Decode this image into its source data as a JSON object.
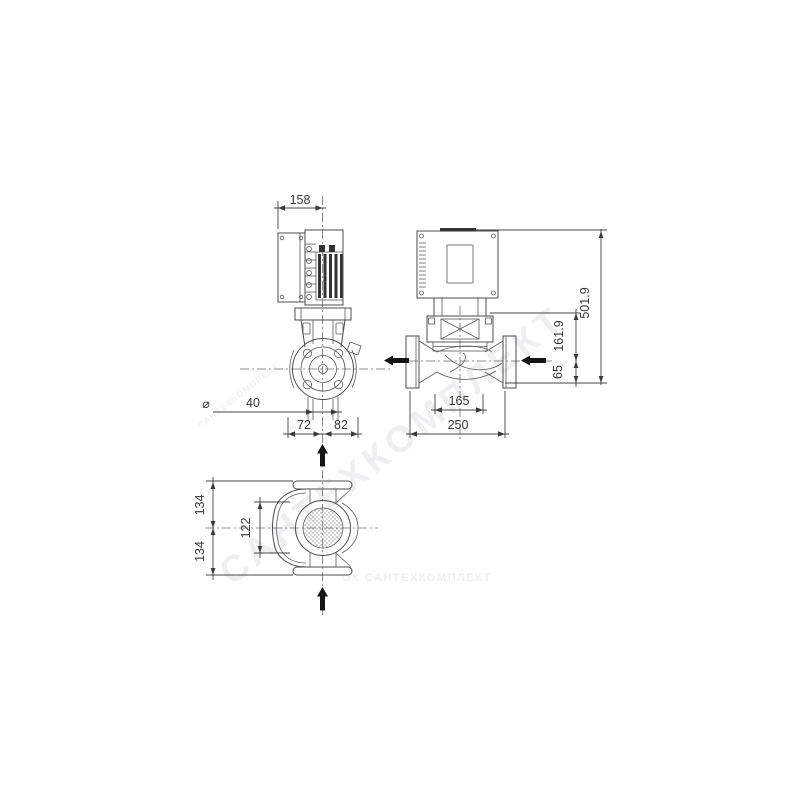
{
  "dims": {
    "front": {
      "motor_width": "158",
      "diameter_symbol": "⌀",
      "port_diameter": "40",
      "offset_left": "72",
      "offset_right": "82"
    },
    "side": {
      "total_height": "501.9",
      "height_axis_to_top_flange": "161.9",
      "height_below_axis": "65",
      "body_width": "165",
      "port_to_port": "250"
    },
    "top": {
      "width_upper": "134",
      "width_inner": "122",
      "width_lower": "134"
    }
  },
  "watermark": {
    "diagonal": "САНТЕХКОМПЛЕКТ",
    "small_diagonal": "САНТЕХКОМПЛЕКТ",
    "footer": "ОК САНТЕХКОМПЛЕКТ"
  },
  "colors": {
    "line": "#4d4d4d",
    "dimension_text": "#363636",
    "flow_arrow": "#141414",
    "watermark": "#edeff1",
    "background": "#ffffff"
  }
}
